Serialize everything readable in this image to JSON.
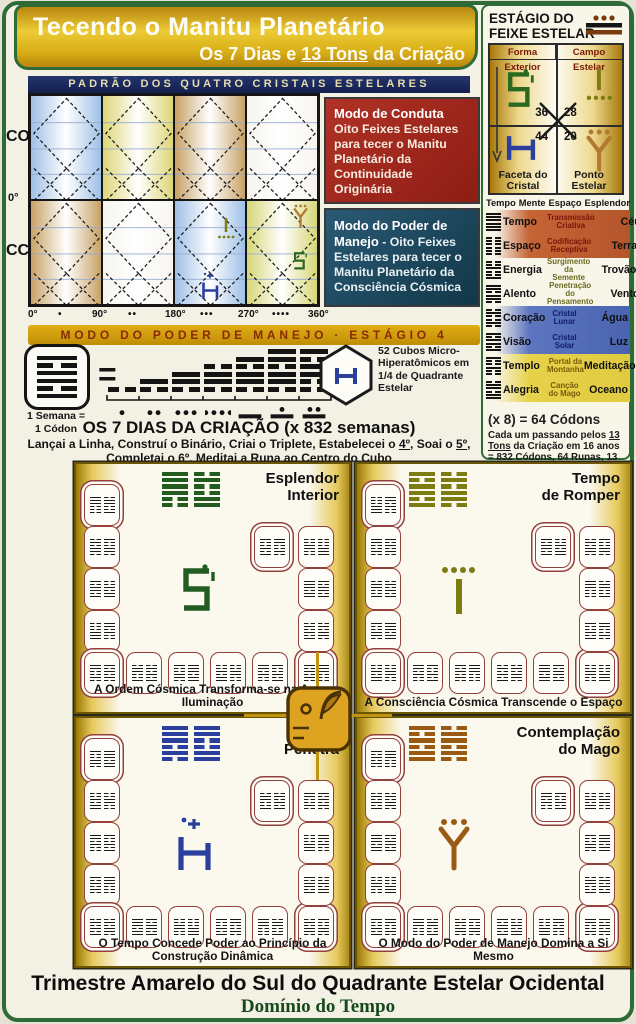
{
  "header": {
    "title": "Tecendo o Manitu Planetário",
    "subtitle_parts": [
      {
        "t": "Os 7 Dias e "
      },
      {
        "t": "13 Tons",
        "u": true
      },
      {
        "t": " da Criação"
      }
    ]
  },
  "pattern_chart": {
    "title": "PADRÃO DOS QUATRO CRISTAIS ESTELARES",
    "left_top_label": "CO",
    "left_bottom_label": "CC",
    "left_zero": "0°",
    "axis_ticks": [
      "0°",
      "90°",
      "180°",
      "270°",
      "360°"
    ],
    "banner": "MODO DO PODER DE MANEJO · ESTÁGIO 4",
    "conduct_box": {
      "title": "Modo de Conduta",
      "text": "Oito Feixes Estelares para tecer o Manitu Planetário da Continuidade Originária"
    },
    "power_box": {
      "title": "Modo do Poder de Manejo",
      "text": " - Oito Feixes Estelares para tecer o Manitu Planetário da Consciência Cósmica"
    },
    "cell_colors": [
      [
        "#9fc0e6",
        "#ddd676",
        "#c8a266",
        "#f7f5ee"
      ],
      [
        "#c8a266",
        "#f7f5ee",
        "#9fc0e6",
        "#d6d676"
      ]
    ]
  },
  "equation": {
    "week_label_1": "1 Semana =",
    "week_label_2": "1 Códon",
    "equals": "=",
    "codon_hex": "101101",
    "stacks": [
      "0",
      "10",
      "110",
      "0110",
      "10110",
      "110110",
      "101100"
    ],
    "mayan_days": [
      1,
      2,
      3,
      4,
      5,
      6,
      7
    ],
    "cubes_label": "52 Cubos Micro-Hiperatômicos em 1/4 de Quadrante Estelar",
    "days_title": "OS 7 DIAS DA CRIAÇÃO (x 832 semanas)",
    "instruction_parts": [
      {
        "t": "Lançai a Linha, Construí o Binário, Criai o Triplete, Estabelecei o "
      },
      {
        "t": "4º",
        "u": true
      },
      {
        "t": ", Soai o "
      },
      {
        "t": "5º",
        "u": true
      },
      {
        "t": ", Completai o "
      },
      {
        "t": "6º",
        "u": true
      },
      {
        "t": ", Meditai a Runa ao Centro do Cubo"
      }
    ]
  },
  "stage_panel": {
    "title_line1": "ESTÁGIO DO",
    "title_line2": "FEIXE ESTELAR",
    "beam_icon": "mayan-numeral-13",
    "grid": {
      "header_left": "Forma Exterior",
      "header_right": "Campo Estelar",
      "n_tl": "36",
      "n_tr": "28",
      "n_bl": "44",
      "n_br": "20",
      "label_left": "Faceta do Cristal",
      "label_right": "Ponto Estelar"
    },
    "table_headers": [
      "Tempo",
      "Mente",
      "Espaço",
      "Esplendor"
    ],
    "rows": [
      {
        "name": "Tempo",
        "desc": "Transmissão Criativa",
        "element": "Céu",
        "hex": "111111",
        "bg": "orange"
      },
      {
        "name": "Espaço",
        "desc": "Codificação Receptiva",
        "element": "Terra",
        "hex": "000000",
        "bg": "orange"
      },
      {
        "name": "Energia",
        "desc": "Surgimento da Semente",
        "element": "Trovão",
        "hex": "001001",
        "bg": "plain"
      },
      {
        "name": "Alento",
        "desc": "Penetração do Pensamento",
        "element": "Vento",
        "hex": "110110",
        "bg": "plain"
      },
      {
        "name": "Coração",
        "desc": "Cristal Lunar",
        "element": "Água",
        "hex": "010010",
        "bg": "blue"
      },
      {
        "name": "Visão",
        "desc": "Cristal Solar",
        "element": "Luz",
        "hex": "101101",
        "bg": "blue"
      },
      {
        "name": "Templo",
        "desc": "Portal da Montanha",
        "element": "Meditação",
        "hex": "100100",
        "bg": "yellow"
      },
      {
        "name": "Alegria",
        "desc": "Canção do Mago",
        "element": "Oceano",
        "hex": "011011",
        "bg": "yellow"
      }
    ],
    "codons_line": "(x 8) = 64 Códons",
    "footnote_parts": [
      {
        "t": "Cada um passando pelos "
      },
      {
        "t": "13 Tons",
        "u": true
      },
      {
        "t": " da Criação em 16 anos = "
      },
      {
        "t": "832",
        "u": true
      },
      {
        "t": " Códons, 64 Runas, "
      },
      {
        "t": "13 Tons",
        "u": true
      },
      {
        "t": " Cada"
      }
    ]
  },
  "quadrants": [
    {
      "title_lines": [
        "Esplendor",
        "Interior"
      ],
      "caption": "A Ordem Cósmica Transforma-se na Auto-Iluminação",
      "color": "#225c20",
      "rune": "esplendor",
      "pair": [
        "111100",
        "010011"
      ]
    },
    {
      "title_lines": [
        "Tempo",
        "de Romper"
      ],
      "caption": "A Consciência Cósmica Transcende o Espaço",
      "color": "#7c7c12",
      "rune": "romper",
      "pair": [
        "101101",
        "010110"
      ]
    },
    {
      "title_lines": [
        "Tempo",
        "Penetra"
      ],
      "caption": "O Tempo Concede Poder ao Princípio da Construção Dinâmica",
      "color": "#2b3f9e",
      "rune": "penetra",
      "pair": [
        "111010",
        "110011"
      ]
    },
    {
      "title_lines": [
        "Contemplação",
        "do Mago"
      ],
      "caption": "O Modo do Poder de Manejo Domina a Si Mesmo",
      "color": "#9a5a14",
      "rune": "mago",
      "pair": [
        "101011",
        "011010"
      ]
    }
  ],
  "tile_codes": [
    "111000",
    "010110",
    "101101",
    "000111",
    "110010",
    "011001",
    "100110",
    "001011",
    "110100",
    "101010",
    "010101",
    "111011",
    "001100",
    "100101"
  ],
  "icons": {
    "beam": "mayan-numeral-13",
    "forma_exterior": "rune-s",
    "campo_estelar": "rune-line-four-dots",
    "faceta_cristal": "rune-antenna",
    "ponto_estelar": "rune-y-three-dots",
    "center": "mayan-head-glyph",
    "cube": "hexagon-cube"
  },
  "footer": {
    "line1": "Trimestre Amarelo do Sul do Quadrante Estelar Ocidental",
    "line2": "Domínio do Tempo"
  },
  "colors": {
    "frame_green": "#2e6b36",
    "gold": "#d8a918",
    "banner_blue": "#1c2a60",
    "red_box": "#9e241a",
    "blue_box": "#1d4a63",
    "gold_banner_text": "#8a2a06"
  }
}
